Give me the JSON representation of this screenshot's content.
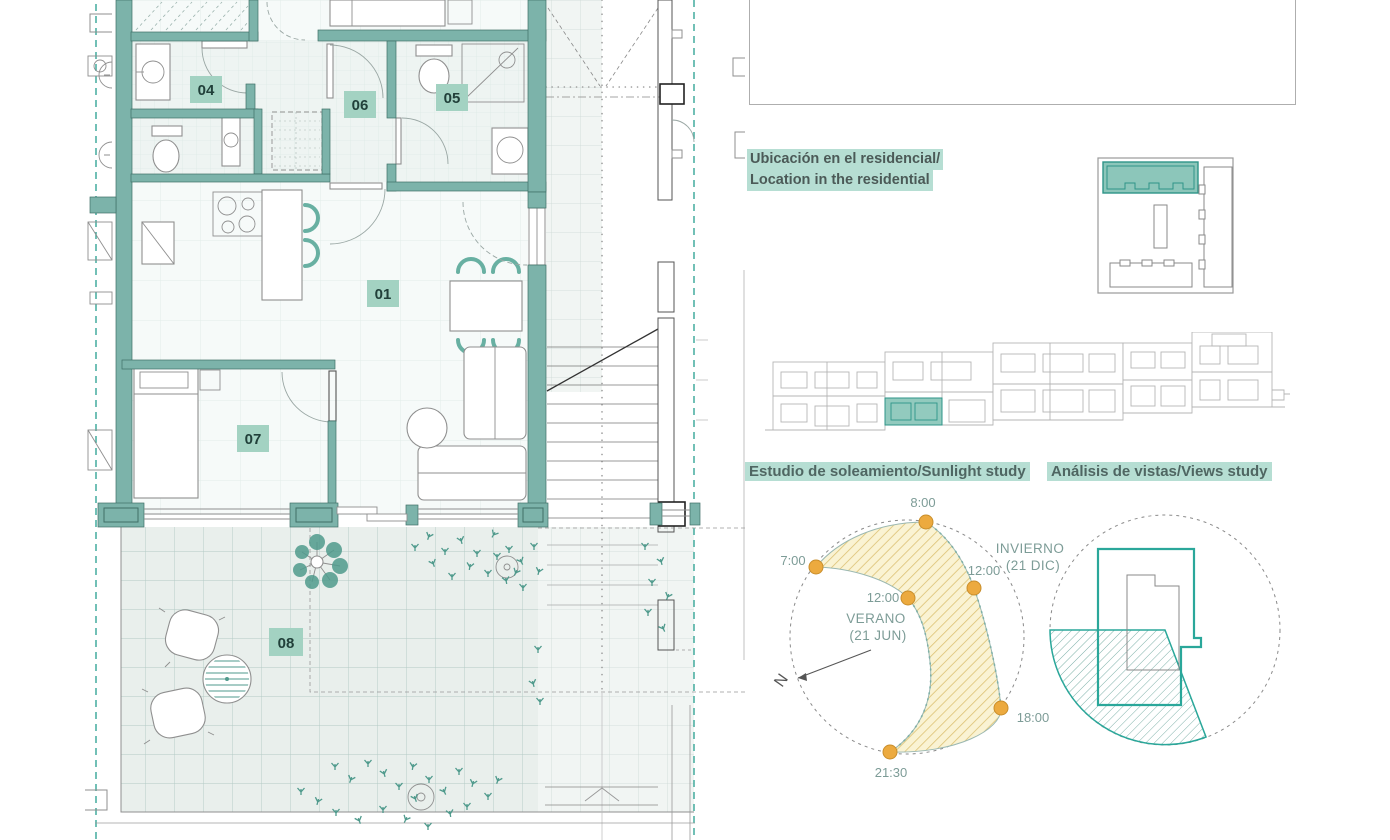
{
  "colors": {
    "wall-teal": "#7cb3aa",
    "wall-dark": "#3f6f67",
    "accent-teal": "#35a597",
    "label-bg": "#a3d2c2",
    "label-text": "#21403a",
    "highlight-bg": "#b6ded3",
    "title-text": "#4f6662",
    "time-text": "#7d9c97",
    "sun-orange": "#ecaa3f",
    "sun-orange-dark": "#c98e2b",
    "band-fill": "#faf3d3",
    "band-hatch": "#dcc173",
    "furn-gray": "#8f8f8f",
    "dark-gray": "#4a4a4a",
    "tile-line": "#b2cac4",
    "tile-fill": "#e9efec",
    "plant-teal": "#4f9a8c",
    "chair-teal": "#68b0a2",
    "views-teal": "#2aa79a",
    "elev-gray": "#b5b5b5",
    "dash-gray": "#999999"
  },
  "floor_plan": {
    "rooms": {
      "r01": "01",
      "r04": "04",
      "r05": "05",
      "r06": "06",
      "r07": "07",
      "r08": "08"
    }
  },
  "location_section": {
    "title_es": "Ubicación en el residencial/",
    "title_en": "Location in the residential"
  },
  "sunlight_study": {
    "title": "Estudio de soleamiento/Sunlight study",
    "times": {
      "morning": "8:00",
      "sunrise_summer": "7:00",
      "noon_summer": "12:00",
      "noon_winter": "12:00",
      "evening": "18:00",
      "sunset_summer": "21:30"
    },
    "winter_label": "INVIERNO",
    "winter_date": "(21 DIC)",
    "summer_label": "VERANO",
    "summer_date": "(21 JUN)",
    "north_label": "N"
  },
  "views_study": {
    "title": "Análisis de vistas/Views study"
  }
}
